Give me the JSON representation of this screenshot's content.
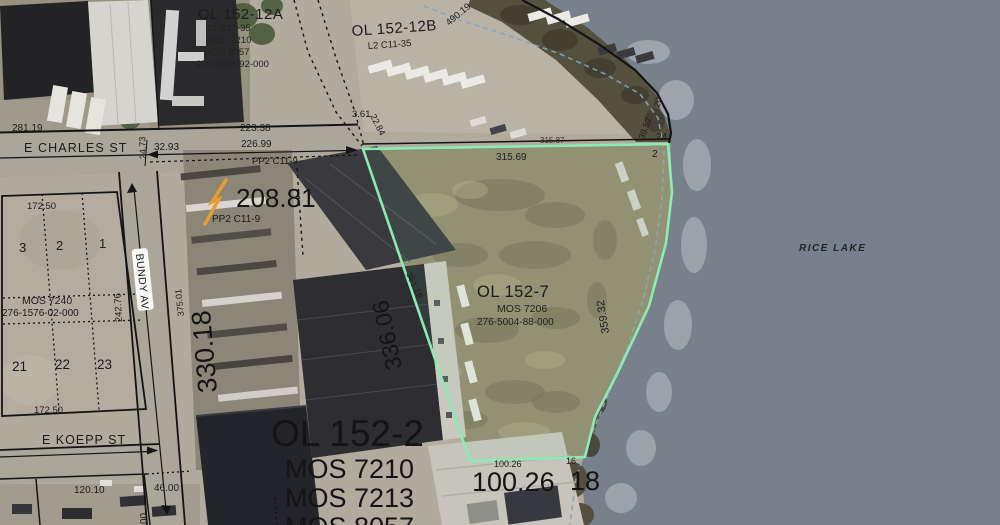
{
  "water": {
    "label": "RICE LAKE"
  },
  "streets": {
    "charles": "E CHARLES ST",
    "koepp": "E KOEPP ST",
    "bundy": "BUNDY AV"
  },
  "parcels": {
    "ol15212a": {
      "title": "OL 152-12A",
      "sub1": "L1 C11-35",
      "sub2": "MOS 7210",
      "sub3": "MOS 8057",
      "sub4": "276-5004-92-000"
    },
    "ol15212b": {
      "title": "OL 152-12B",
      "sub1": "L2 C11-35"
    },
    "ol1527": {
      "title": "OL 152-7",
      "sub1": "MOS 7206",
      "sub2": "276-5004-88-000"
    },
    "ol1522": {
      "title": "OL 152-2",
      "sub1": "MOS 7210",
      "sub2": "MOS 7213",
      "sub3": "MOS 8057"
    },
    "block": {
      "mos": "MOS 7240",
      "id": "276-1576-02-000"
    },
    "pp2_street": "PP2 C11-9",
    "pp2_block": "PP2 C11-9",
    "lots": {
      "l1": "1",
      "l2": "2",
      "l3": "3",
      "l21": "21",
      "l22": "22",
      "l23": "23"
    }
  },
  "dims": {
    "d281_19": "281.19",
    "d223_38": "223.38",
    "d226_99": "226.99",
    "d32_93": "32.93",
    "d24_73": "24.73",
    "d3_61": "3.61",
    "d22_84": "22.84",
    "d490_19": "490.19",
    "d315_87": "315.87",
    "d315_69": "315.69",
    "d20": "20",
    "d39_52": "39.52",
    "d24": "24",
    "d2": "2",
    "d359_32": "359.32",
    "d361_18": "361.18",
    "d336_06": "336.06",
    "d330_18": "330.18",
    "d375_01": "375.01",
    "d242_76": "242.76",
    "d172_50_a": "172.50",
    "d172_50_b": "172.50",
    "d208_81": "208.81",
    "d120_10": "120.10",
    "d46_00": "46.00",
    "d100_26_s": "100.26",
    "d16": "16",
    "d100_26_b": "100.26",
    "d18": "18",
    "d00": "00"
  },
  "colors": {
    "highlight": "#8bebb4",
    "shore_dash": "#8ba3b5",
    "mark": "#e59c35",
    "water_text": "#3b4fc8"
  }
}
